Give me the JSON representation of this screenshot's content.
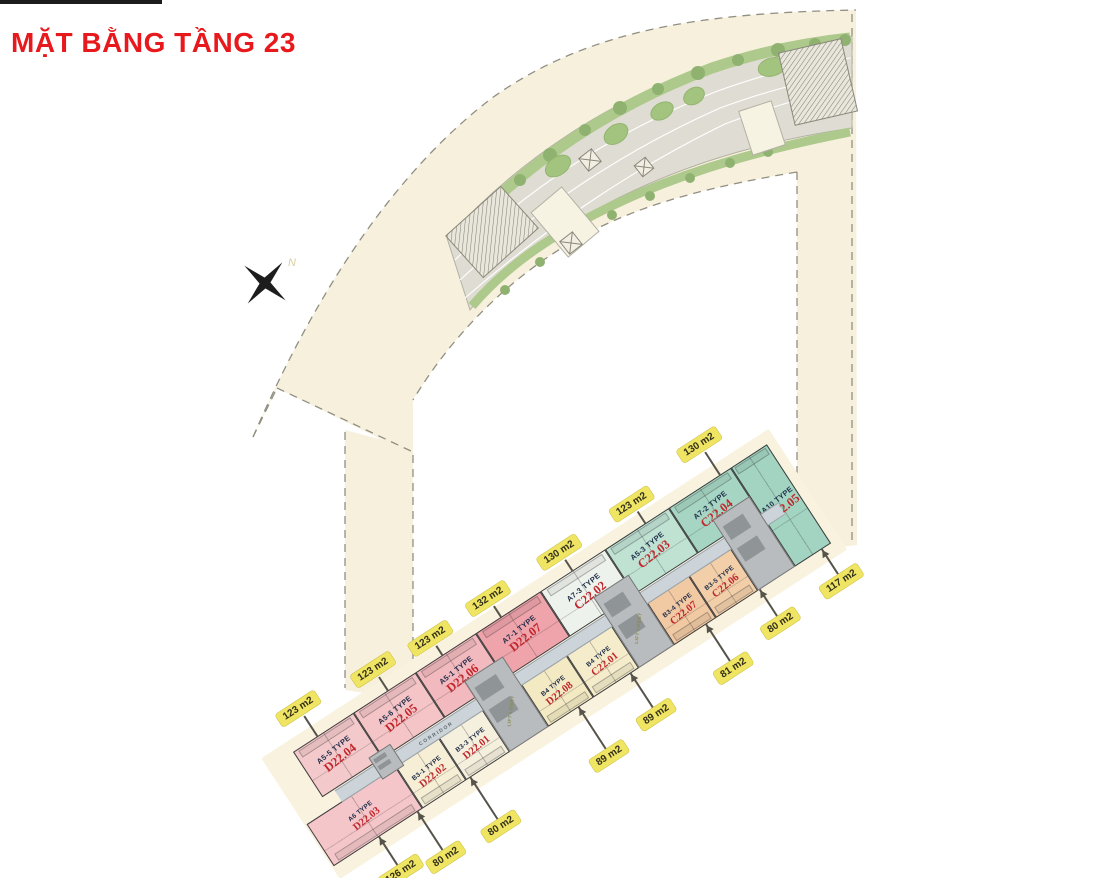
{
  "title": "MẶT BẰNG TẦNG 23",
  "compass": {
    "label": "N"
  },
  "colors": {
    "title_red": "#e8191c",
    "tag_bg": "#f0e562",
    "code_red": "#c1272d",
    "type_navy": "#1f2c49",
    "site_beige": "#f6f0dd",
    "deck_gray": "#dfddd3",
    "garden_green": "#adc98b",
    "corridor_gray": "#ccd4d9",
    "core_gray": "#b9bcbe"
  },
  "building": {
    "corridor_labels": [
      "CORRIDOR",
      "CORRIDOR"
    ],
    "units": [
      {
        "type": "A5-5 TYPE",
        "code": "D22.04",
        "area": "123 m2",
        "color": "#f4c9cb",
        "row": "top",
        "x": 0,
        "w": 72,
        "tag_cx": 28,
        "tag_len": 24
      },
      {
        "type": "A5-6 TYPE",
        "code": "D22.05",
        "area": "123 m2",
        "color": "#f4c4c7",
        "row": "top",
        "x": 72,
        "w": 74,
        "tag_cx": 112,
        "tag_len": 16
      },
      {
        "type": "A5-1 TYPE",
        "code": "D22.06",
        "area": "123 m2",
        "color": "#f2b9be",
        "row": "top",
        "x": 146,
        "w": 72,
        "tag_cx": 177,
        "tag_len": 11
      },
      {
        "type": "A7-1 TYPE",
        "code": "D22.07",
        "area": "132 m2",
        "color": "#efa3ab",
        "row": "top",
        "x": 218,
        "w": 77,
        "tag_cx": 247,
        "tag_len": 13
      },
      {
        "type": "A7-3 TYPE",
        "code": "C22.02",
        "area": "130 m2",
        "color": "#eef2ec",
        "row": "top",
        "x": 295,
        "w": 77,
        "tag_cx": 332,
        "tag_len": 13
      },
      {
        "type": "A5-3 TYPE",
        "code": "C22.03",
        "area": "123 m2",
        "color": "#bfe2d3",
        "row": "top",
        "x": 372,
        "w": 76,
        "tag_cx": 419,
        "tag_len": 14
      },
      {
        "type": "A7-2 TYPE",
        "code": "C22.04",
        "area": "130 m2",
        "color": "#a6d6c3",
        "row": "top",
        "x": 448,
        "w": 74,
        "tag_cx": 508,
        "tag_len": 27
      },
      {
        "type": "A6 TYPE",
        "code": "D22.03",
        "area": "126 m2",
        "color": "#f4c6c9",
        "row": "bottom",
        "x": -28,
        "w": 106,
        "tag_cx": 25,
        "tag_len": 34
      },
      {
        "type": "B3-1 TYPE",
        "code": "D22.02",
        "area": "80 m2",
        "color": "#f6efd6",
        "row": "bottom",
        "x": 78,
        "w": 52,
        "tag_cx": 71,
        "tag_len": 46
      },
      {
        "type": "B3-3 TYPE",
        "code": "D22.01",
        "area": "80 m2",
        "color": "#f5f0dd",
        "row": "bottom",
        "x": 130,
        "w": 52,
        "tag_cx": 134,
        "tag_len": 50
      },
      {
        "type": "B4 TYPE",
        "code": "D22.08",
        "area": "89 m2",
        "color": "#f3e9c3",
        "row": "bottom",
        "x": 228,
        "w": 54,
        "tag_cx": 263,
        "tag_len": 50
      },
      {
        "type": "B4 TYPE",
        "code": "C22.01",
        "area": "89 m2",
        "color": "#f4ecca",
        "row": "bottom",
        "x": 282,
        "w": 54,
        "tag_cx": 325,
        "tag_len": 41
      },
      {
        "type": "B3-4 TYPE",
        "code": "C22.07",
        "area": "81 m2",
        "color": "#f1c9a3",
        "row": "bottom",
        "x": 378,
        "w": 50,
        "tag_cx": 415,
        "tag_len": 44
      },
      {
        "type": "B3-5 TYPE",
        "code": "C22.06",
        "area": "80 m2",
        "color": "#f2cfa9",
        "row": "bottom",
        "x": 428,
        "w": 50,
        "tag_cx": 479,
        "tag_len": 32
      },
      {
        "type": "A10 TYPE",
        "code": "C22.05",
        "area": "117 m2",
        "color": "#a2d4c1",
        "row": "end",
        "x": 522,
        "w": 43,
        "tag_cx": 553,
        "tag_len": 30
      }
    ],
    "cores": [
      {
        "x": 60,
        "y": 46,
        "w": 26,
        "h": 26,
        "label": ""
      },
      {
        "x": 182,
        "y": 34,
        "w": 46,
        "h": 84,
        "label": "LIFT LOBBY"
      },
      {
        "x": 336,
        "y": 34,
        "w": 42,
        "h": 84,
        "label": "LIFT LOBBY"
      },
      {
        "x": 478,
        "y": 34,
        "w": 44,
        "h": 84,
        "label": ""
      }
    ]
  }
}
